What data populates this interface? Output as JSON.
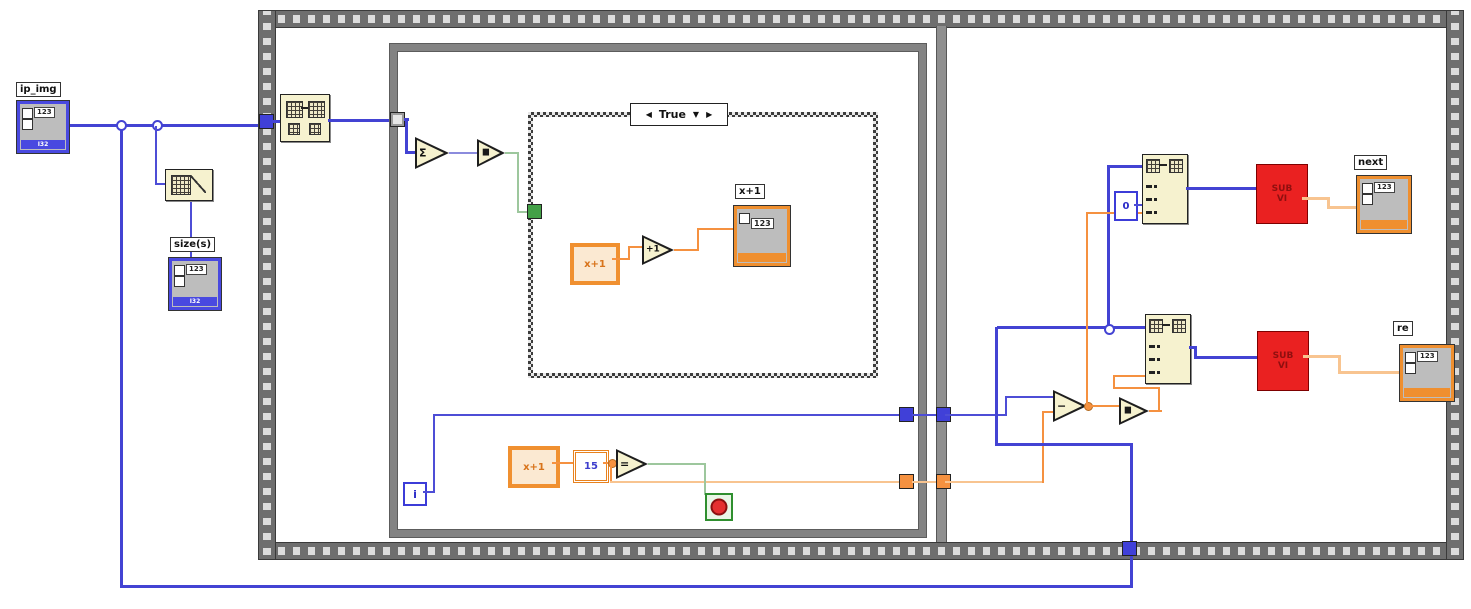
{
  "ip_img": {
    "label": "ip_img",
    "display": "123",
    "type": "I32"
  },
  "size": {
    "label": "size(s)",
    "display": "123",
    "type": "I32"
  },
  "caseframe": {
    "selector": "True",
    "prev": "◀",
    "drop": "▼",
    "next": "▶"
  },
  "inner": {
    "local": "x+1",
    "inc": "+1",
    "ind_label": "x+1",
    "ind_display": "123"
  },
  "loop": {
    "iter": "i",
    "local": "x+1",
    "const": "15",
    "eq": "=",
    "sum": "Σ",
    "cmp": "▮▮"
  },
  "right": {
    "zero": "0",
    "sub": "−",
    "cmp": "▮▮",
    "subvi1": "SUB VI",
    "subvi2": "SUB VI",
    "next_label": "next",
    "next_display": "123",
    "re_label": "re",
    "re_display": "123"
  }
}
